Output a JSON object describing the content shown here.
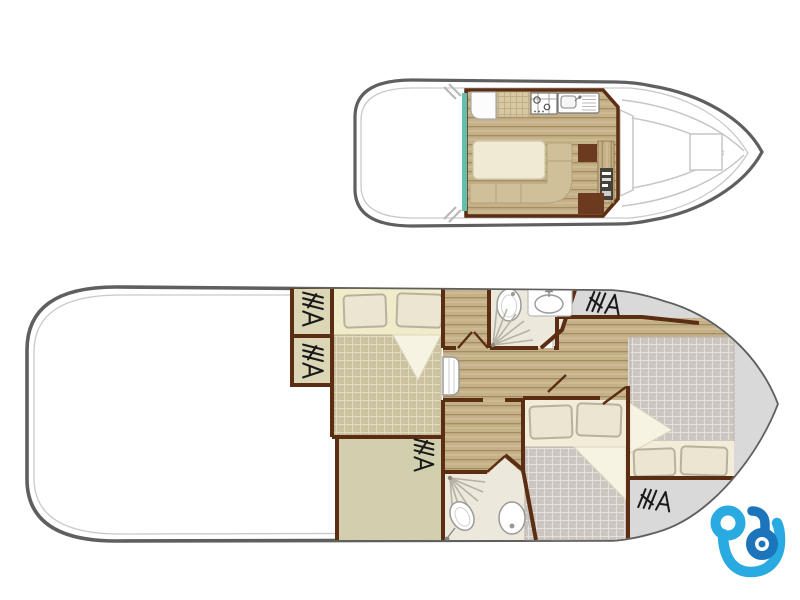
{
  "document": {
    "kind": "boat-deck-floorplan",
    "plan_count": 2
  },
  "colors": {
    "hull_outline": "#5f5f5f",
    "gunwale": "#c9c9c9",
    "deck_line": "#c6c6c6",
    "wall": "#5b2d12",
    "wood": "#c5b189",
    "wood_line": "#a18a5c",
    "wood_hi": "#d4c39d",
    "counter": "#d8c9a3",
    "khaki_blanket": "#cbc29e",
    "gray_blanket": "#cdc6c0",
    "sheet": "#f2ecd8",
    "sheet_aft": "#f0ebc9",
    "fold": "#f7f3e3",
    "pillow": "#ece5d2",
    "pillow_edge": "#b9b19f",
    "bath_floor": "#ece8dc",
    "fixture_stroke": "#9a9a96",
    "wardrobe": "#dbd6b6",
    "olive": "#d2cfae",
    "deck_gray": "#d9d9d9",
    "hanger": "#1a1a1a",
    "teal_door": "#62bfae",
    "cabinet_brown": "#6b3a1f",
    "console_dark": "#45413b",
    "logo_light": "#29abe2",
    "logo_dark": "#1c75bb"
  },
  "plans": {
    "upper_deck": {
      "name": "upper-deck-plan",
      "features": [
        "stern-deck",
        "sliding-door",
        "fridge",
        "galley-counter",
        "stove",
        "sink-with-drainer",
        "dinette-table",
        "u-shaped-bench",
        "storage-cabinets",
        "helm-console",
        "windshield",
        "bow-hatch"
      ]
    },
    "lower_deck": {
      "name": "lower-deck-plan",
      "rooms": [
        {
          "name": "aft-cabin",
          "items": [
            "double-bed",
            "2-pillows",
            "wardrobe-upper",
            "wardrobe-lower"
          ]
        },
        {
          "name": "storage-room",
          "items": [
            "hanger-rack"
          ]
        },
        {
          "name": "forward-bathroom",
          "items": [
            "toilet",
            "washbasin",
            "shower"
          ]
        },
        {
          "name": "aft-bathroom",
          "items": [
            "shower",
            "washbasin",
            "toilet"
          ]
        },
        {
          "name": "middle-cabin",
          "items": [
            "double-bed",
            "2-pillows"
          ]
        },
        {
          "name": "bow-cabin",
          "items": [
            "double-bed",
            "2-pillows"
          ]
        },
        {
          "name": "corridor",
          "items": [
            "companionway-steps",
            "doors"
          ]
        },
        {
          "name": "foredeck",
          "items": [
            "hanger-rack",
            "hanger-rack"
          ]
        }
      ]
    }
  },
  "inventory": {
    "double_beds": 3,
    "pillows": 6,
    "bathrooms": 2,
    "toilets": 2,
    "sinks": 3,
    "showers": 2,
    "hanger_racks": 5,
    "stove": 1,
    "fridge": 1,
    "dinette_table": 1
  },
  "logo": {
    "name": "brand-logo-b"
  }
}
